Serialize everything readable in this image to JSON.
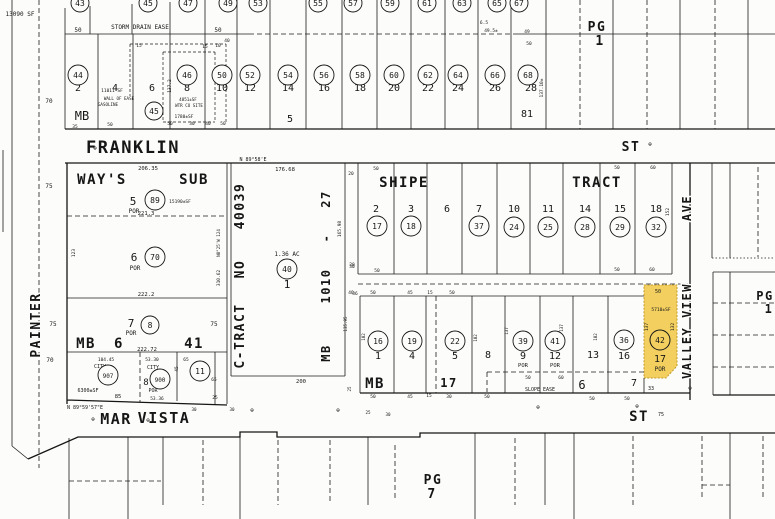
{
  "colors": {
    "ink": "#161616",
    "paper": "#fcfcfa",
    "highlight": "#F2CF5F",
    "highlight_border": "#c39a2a"
  },
  "streets": {
    "franklin": "FRANKLIN",
    "franklin_suffix": "ST",
    "mar_vista_1": "MAR",
    "mar_vista_2": "VISTA",
    "mar_vista_suffix": "ST",
    "painter": "PAINTER",
    "valley_view": "VALLEY VIEW",
    "valley_view_suffix": "AVE"
  },
  "tracts": {
    "ways_1": "WAY'S",
    "ways_2": "SUB",
    "shipe": "SHIPE",
    "shipe_2": "TRACT",
    "ctract": "C-TRACT",
    "ctract_no": "NO",
    "ctract_num": "40039",
    "mb": "MB",
    "mb_num": "1010",
    "mb_dash": "-",
    "mb_page": "27",
    "mb6": "MB",
    "mb6_num": "6",
    "mb6_page": "41",
    "mb17_mb": "MB",
    "mb17_num": "17"
  },
  "pages": {
    "pg_top_right": "PG",
    "pg_top_right_num": "1",
    "pg_right": "PG",
    "pg_right_num": "1",
    "pg_bottom": "PG",
    "pg_bottom_num": "7"
  },
  "highlight": {
    "circle": "42",
    "lot": "17",
    "por": "POR",
    "area": "5710±SF",
    "top_dim": "50",
    "left_dim": "137",
    "right_dim": "132",
    "bottom_dim": "33"
  },
  "monument_symbol": "⊕",
  "monuments": [
    [
      95,
      150
    ],
    [
      650,
      146
    ],
    [
      93,
      421
    ],
    [
      148,
      422
    ],
    [
      252,
      412
    ],
    [
      338,
      412
    ],
    [
      538,
      409
    ],
    [
      637,
      408
    ],
    [
      690,
      390
    ]
  ],
  "lots": [
    [
      "2",
      78,
      91
    ],
    [
      "4",
      115,
      91
    ],
    [
      "6",
      152,
      91
    ],
    [
      "8",
      187,
      91
    ],
    [
      "10",
      222,
      91
    ],
    [
      "12",
      250,
      91
    ],
    [
      "14",
      288,
      91
    ],
    [
      "16",
      324,
      91
    ],
    [
      "18",
      360,
      91
    ],
    [
      "20",
      394,
      91
    ],
    [
      "22",
      428,
      91
    ],
    [
      "24",
      458,
      91
    ],
    [
      "26",
      495,
      91
    ],
    [
      "28",
      531,
      91
    ],
    [
      "5",
      290,
      122
    ],
    [
      "81",
      527,
      117
    ],
    [
      "5",
      133,
      205,
      11
    ],
    [
      "6",
      134,
      261,
      11
    ],
    [
      "7",
      131,
      327,
      11
    ],
    [
      "8",
      146,
      385,
      9
    ],
    [
      "1",
      287,
      288,
      11
    ],
    [
      "2",
      376,
      212
    ],
    [
      "3",
      411,
      212
    ],
    [
      "6",
      447,
      212
    ],
    [
      "7",
      479,
      212
    ],
    [
      "10",
      514,
      212
    ],
    [
      "11",
      548,
      212
    ],
    [
      "14",
      585,
      212
    ],
    [
      "15",
      620,
      212
    ],
    [
      "18",
      656,
      212
    ],
    [
      "1",
      378,
      359
    ],
    [
      "4",
      412,
      359
    ],
    [
      "5",
      455,
      359
    ],
    [
      "8",
      488,
      358
    ],
    [
      "9",
      523,
      359
    ],
    [
      "12",
      555,
      359
    ],
    [
      "13",
      593,
      358
    ],
    [
      "16",
      624,
      359
    ],
    [
      "6",
      582,
      389,
      12
    ],
    [
      "7",
      634,
      386,
      10
    ]
  ],
  "circles": [
    [
      "43",
      80,
      3,
      9
    ],
    [
      "45",
      148,
      3,
      9
    ],
    [
      "47",
      188,
      3,
      9
    ],
    [
      "49",
      228,
      3,
      9
    ],
    [
      "53",
      258,
      3,
      9
    ],
    [
      "55",
      318,
      3,
      9
    ],
    [
      "57",
      353,
      3,
      9
    ],
    [
      "59",
      390,
      3,
      9
    ],
    [
      "61",
      427,
      3,
      9
    ],
    [
      "63",
      462,
      3,
      9
    ],
    [
      "65",
      497,
      3,
      9
    ],
    [
      "67",
      519,
      3,
      9
    ],
    [
      "44",
      78,
      75
    ],
    [
      "46",
      187,
      75
    ],
    [
      "50",
      222,
      75
    ],
    [
      "52",
      250,
      75
    ],
    [
      "54",
      288,
      75
    ],
    [
      "56",
      324,
      75
    ],
    [
      "58",
      360,
      75
    ],
    [
      "60",
      394,
      75
    ],
    [
      "62",
      428,
      75
    ],
    [
      "64",
      458,
      75
    ],
    [
      "66",
      495,
      75
    ],
    [
      "68",
      528,
      75
    ],
    [
      "45",
      154,
      111,
      9
    ],
    [
      "89",
      155,
      200
    ],
    [
      "70",
      155,
      257
    ],
    [
      "8",
      150,
      325,
      9
    ],
    [
      "907",
      108,
      375
    ],
    [
      "900",
      160,
      379
    ],
    [
      "11",
      200,
      371
    ],
    [
      "40",
      287,
      269
    ],
    [
      "17",
      377,
      226
    ],
    [
      "18",
      411,
      226
    ],
    [
      "37",
      479,
      226
    ],
    [
      "24",
      514,
      227
    ],
    [
      "25",
      548,
      227
    ],
    [
      "28",
      585,
      227
    ],
    [
      "29",
      620,
      227
    ],
    [
      "32",
      656,
      227
    ],
    [
      "16",
      378,
      341
    ],
    [
      "19",
      412,
      341
    ],
    [
      "22",
      455,
      341
    ],
    [
      "39",
      523,
      341
    ],
    [
      "41",
      555,
      341
    ],
    [
      "36",
      624,
      340
    ]
  ],
  "dims": [
    {
      "t": "13090 SF",
      "x": 20,
      "y": 16,
      "s": 6
    },
    {
      "t": "STORM DRAIN EASE",
      "x": 140,
      "y": 29,
      "s": 6
    },
    {
      "t": "50",
      "x": 78,
      "y": 32,
      "s": 6
    },
    {
      "t": "50",
      "x": 218,
      "y": 32,
      "s": 6
    },
    {
      "t": "15",
      "x": 139,
      "y": 47,
      "s": 4.5
    },
    {
      "t": "15",
      "x": 205,
      "y": 48,
      "s": 4.5
    },
    {
      "t": "10",
      "x": 218,
      "y": 47,
      "s": 4.5
    },
    {
      "t": "40",
      "x": 227,
      "y": 42,
      "s": 4.5
    },
    {
      "t": "6.5",
      "x": 484,
      "y": 24,
      "s": 4.5
    },
    {
      "t": "49.5±",
      "x": 491,
      "y": 32,
      "s": 4.5
    },
    {
      "t": "49",
      "x": 527,
      "y": 33,
      "s": 4.5
    },
    {
      "t": "50",
      "x": 529,
      "y": 45,
      "s": 4.5
    },
    {
      "t": "11011 SF",
      "x": 112,
      "y": 92,
      "s": 4.5
    },
    {
      "t": "WALL OF EASE",
      "x": 119,
      "y": 100,
      "s": 4.2
    },
    {
      "t": "GASOLINE",
      "x": 108,
      "y": 106,
      "s": 4.2
    },
    {
      "t": "4851±SF",
      "x": 188,
      "y": 101,
      "s": 4.2
    },
    {
      "t": "WTR CO SITE",
      "x": 189,
      "y": 107,
      "s": 4.2
    },
    {
      "t": "1780±SF",
      "x": 184,
      "y": 118,
      "s": 4.5
    },
    {
      "t": "137.2",
      "x": 171,
      "y": 86,
      "s": 4.5,
      "r": -90
    },
    {
      "t": "137.10±",
      "x": 543,
      "y": 88,
      "s": 4.5,
      "r": -90
    },
    {
      "t": "MB",
      "x": 82,
      "y": 120,
      "s": 12
    },
    {
      "t": "35",
      "x": 75,
      "y": 128,
      "s": 4.5
    },
    {
      "t": "50",
      "x": 110,
      "y": 126,
      "s": 4.5
    },
    {
      "t": "50",
      "x": 170,
      "y": 125,
      "s": 4.5
    },
    {
      "t": "30",
      "x": 192,
      "y": 125,
      "s": 4.5
    },
    {
      "t": "40",
      "x": 208,
      "y": 125,
      "s": 4.5
    },
    {
      "t": "50",
      "x": 223,
      "y": 125,
      "s": 4.5
    },
    {
      "t": "70",
      "x": 49,
      "y": 103,
      "s": 6
    },
    {
      "t": "75",
      "x": 49,
      "y": 188,
      "s": 6
    },
    {
      "t": "123",
      "x": 75,
      "y": 253,
      "s": 4.5,
      "r": -90
    },
    {
      "t": "206.35",
      "x": 148,
      "y": 170,
      "s": 5.5
    },
    {
      "t": "N 89°58'E",
      "x": 253,
      "y": 161,
      "s": 5
    },
    {
      "t": "176.68",
      "x": 285,
      "y": 171,
      "s": 5.5
    },
    {
      "t": "15190±SF",
      "x": 180,
      "y": 203,
      "s": 4.5
    },
    {
      "t": "POR",
      "x": 134,
      "y": 213,
      "s": 6
    },
    {
      "t": "221.3",
      "x": 146,
      "y": 215,
      "s": 5.5
    },
    {
      "t": "POR",
      "x": 135,
      "y": 270,
      "s": 6
    },
    {
      "t": "N0°25'W 124",
      "x": 220,
      "y": 243,
      "s": 4.2,
      "r": -90
    },
    {
      "t": "310.62",
      "x": 220,
      "y": 278,
      "s": 4.5,
      "r": -90
    },
    {
      "t": "222.2",
      "x": 146,
      "y": 296,
      "s": 5.5
    },
    {
      "t": "75",
      "x": 53,
      "y": 326,
      "s": 6
    },
    {
      "t": "75",
      "x": 214,
      "y": 326,
      "s": 6
    },
    {
      "t": "POR",
      "x": 131,
      "y": 335,
      "s": 6
    },
    {
      "t": "222.72",
      "x": 147,
      "y": 351,
      "s": 5.5
    },
    {
      "t": "70",
      "x": 50,
      "y": 362,
      "s": 6
    },
    {
      "t": "104.45",
      "x": 106,
      "y": 361,
      "s": 4.5
    },
    {
      "t": "53.30",
      "x": 152,
      "y": 361,
      "s": 4.5
    },
    {
      "t": "CITY",
      "x": 100,
      "y": 368,
      "s": 5
    },
    {
      "t": "CITY",
      "x": 153,
      "y": 369,
      "s": 5
    },
    {
      "t": "65",
      "x": 186,
      "y": 361,
      "s": 4.5
    },
    {
      "t": "45",
      "x": 178,
      "y": 369,
      "s": 4.5,
      "r": -90
    },
    {
      "t": "65",
      "x": 214,
      "y": 381,
      "s": 4.5
    },
    {
      "t": "6300±SF",
      "x": 88,
      "y": 392,
      "s": 5
    },
    {
      "t": "POR",
      "x": 153,
      "y": 392,
      "s": 5
    },
    {
      "t": "85",
      "x": 118,
      "y": 398,
      "s": 5.5
    },
    {
      "t": "53.36",
      "x": 157,
      "y": 400,
      "s": 4.5
    },
    {
      "t": "25",
      "x": 215,
      "y": 399,
      "s": 4.5
    },
    {
      "t": "N 89°59'57\"E",
      "x": 85,
      "y": 409,
      "s": 5
    },
    {
      "t": "30",
      "x": 194,
      "y": 411,
      "s": 4.2
    },
    {
      "t": "30",
      "x": 232,
      "y": 411,
      "s": 4.2
    },
    {
      "t": "1.36 AC",
      "x": 287,
      "y": 256,
      "s": 6
    },
    {
      "t": "165.98",
      "x": 341,
      "y": 229,
      "s": 4.5,
      "r": -90
    },
    {
      "t": "200",
      "x": 301,
      "y": 383,
      "s": 5.5
    },
    {
      "t": "30",
      "x": 352,
      "y": 268,
      "s": 4.5
    },
    {
      "t": "36",
      "x": 355,
      "y": 295,
      "s": 4.5
    },
    {
      "t": "135.95",
      "x": 347,
      "y": 324,
      "s": 4.2,
      "r": -90
    },
    {
      "t": "25",
      "x": 351,
      "y": 389,
      "s": 4.2,
      "r": -90
    },
    {
      "t": "50",
      "x": 376,
      "y": 170,
      "s": 4.5
    },
    {
      "t": "50",
      "x": 617,
      "y": 169,
      "s": 4.5
    },
    {
      "t": "60",
      "x": 653,
      "y": 169,
      "s": 4.5
    },
    {
      "t": "20",
      "x": 351,
      "y": 175,
      "s": 4.5
    },
    {
      "t": "20",
      "x": 352,
      "y": 266,
      "s": 4.5
    },
    {
      "t": "50",
      "x": 377,
      "y": 272,
      "s": 4.5
    },
    {
      "t": "50",
      "x": 617,
      "y": 271,
      "s": 4.5
    },
    {
      "t": "60",
      "x": 652,
      "y": 271,
      "s": 4.5
    },
    {
      "t": "152",
      "x": 669,
      "y": 212,
      "s": 4.5,
      "r": -90
    },
    {
      "t": "40",
      "x": 351,
      "y": 294,
      "s": 4.5
    },
    {
      "t": "50",
      "x": 373,
      "y": 294,
      "s": 4.5
    },
    {
      "t": "45",
      "x": 410,
      "y": 294,
      "s": 4.5
    },
    {
      "t": "15",
      "x": 430,
      "y": 294,
      "s": 4.5
    },
    {
      "t": "50",
      "x": 452,
      "y": 294,
      "s": 4.5
    },
    {
      "t": "102",
      "x": 365,
      "y": 337,
      "s": 4.2,
      "r": -90
    },
    {
      "t": "102",
      "x": 477,
      "y": 338,
      "s": 4.2,
      "r": -90
    },
    {
      "t": "137",
      "x": 508,
      "y": 331,
      "s": 4.2,
      "r": -90
    },
    {
      "t": "137",
      "x": 563,
      "y": 328,
      "s": 4.2,
      "r": -90
    },
    {
      "t": "102",
      "x": 597,
      "y": 337,
      "s": 4.2,
      "r": -90
    },
    {
      "t": "132",
      "x": 634,
      "y": 341,
      "s": 4.2,
      "r": -90
    },
    {
      "t": "POR",
      "x": 523,
      "y": 367,
      "s": 5.5
    },
    {
      "t": "POR",
      "x": 555,
      "y": 367,
      "s": 5.5
    },
    {
      "t": "50",
      "x": 528,
      "y": 379,
      "s": 4.5
    },
    {
      "t": "60",
      "x": 561,
      "y": 379,
      "s": 4.5
    },
    {
      "t": "SLOPE EASE",
      "x": 540,
      "y": 391,
      "s": 5
    },
    {
      "t": "50",
      "x": 373,
      "y": 398,
      "s": 4.5
    },
    {
      "t": "45",
      "x": 410,
      "y": 398,
      "s": 4.5
    },
    {
      "t": "15",
      "x": 429,
      "y": 397,
      "s": 4.5
    },
    {
      "t": "30",
      "x": 449,
      "y": 398,
      "s": 4.5
    },
    {
      "t": "50",
      "x": 487,
      "y": 398,
      "s": 4.5
    },
    {
      "t": "50",
      "x": 592,
      "y": 400,
      "s": 4.5
    },
    {
      "t": "50",
      "x": 627,
      "y": 400,
      "s": 4.5
    },
    {
      "t": "75",
      "x": 661,
      "y": 416,
      "s": 5
    },
    {
      "t": "25",
      "x": 368,
      "y": 414,
      "s": 4.2
    },
    {
      "t": "30",
      "x": 388,
      "y": 416,
      "s": 4.2
    }
  ]
}
